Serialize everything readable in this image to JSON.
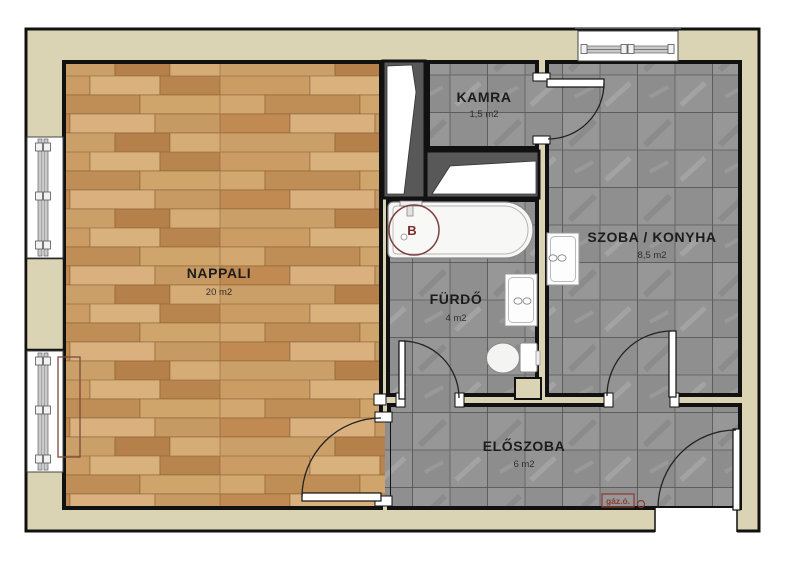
{
  "title": "apartment-floor-plan",
  "rooms": [
    {
      "id": "nappali",
      "name": "NAPPALI",
      "area": "20 m2",
      "floor": "wood"
    },
    {
      "id": "kamra",
      "name": "KAMRA",
      "area": "1,5 m2",
      "floor": "tile"
    },
    {
      "id": "szoba-konyha",
      "name": "SZOBA / KONYHA",
      "area": "8,5 m2",
      "floor": "tile"
    },
    {
      "id": "furdo",
      "name": "FÜRDŐ",
      "area": "4 m2",
      "floor": "tile"
    },
    {
      "id": "eloszoba",
      "name": "ELŐSZOBA",
      "area": "6 m2",
      "floor": "tile"
    }
  ],
  "fixtures": {
    "boiler_label": "B",
    "gas_meter_label": "gáz.ó."
  },
  "colors": {
    "wall_fill": "#dad4b4",
    "wall_line": "#111111",
    "wood_floor": "#c79a63",
    "tile_floor": "#8f8f8f",
    "shaft_fill": "#585858",
    "accent_red": "#8b3a35",
    "boiler_red": "#7b4040",
    "fixture_white": "#f7f7f5"
  }
}
